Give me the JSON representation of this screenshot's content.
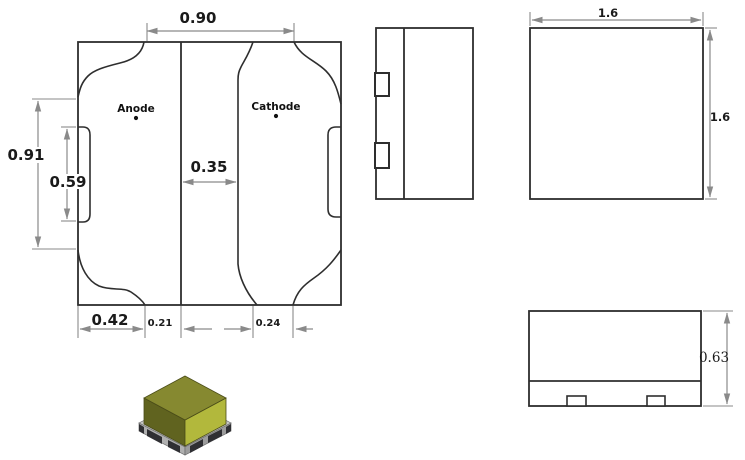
{
  "solder_pad_layout": {
    "anode_label": "Anode",
    "cathode_label": "Cathode",
    "dim_pad_span_top": "0.90",
    "dim_height_overall": "0.91",
    "dim_height_side_notch": "0.59",
    "dim_gap_center": "0.35",
    "dim_pad_width_bottom": "0.42",
    "dim_offset_bottom_left": "0.21",
    "dim_offset_bottom_right": "0.24"
  },
  "top_view": {
    "dim_width": "1.6",
    "dim_height": "1.6"
  },
  "front_view": {
    "dim_height": "0.63"
  },
  "colors": {
    "outline": "#2e2e2e",
    "dimension_lines": "#8a8a8a",
    "chip_top_face": "#868930",
    "chip_right_face": "#b2b83c",
    "chip_left_face": "#60631f",
    "chip_base": "#b5b5b5",
    "chip_contact_pads": "#2f2f33"
  }
}
